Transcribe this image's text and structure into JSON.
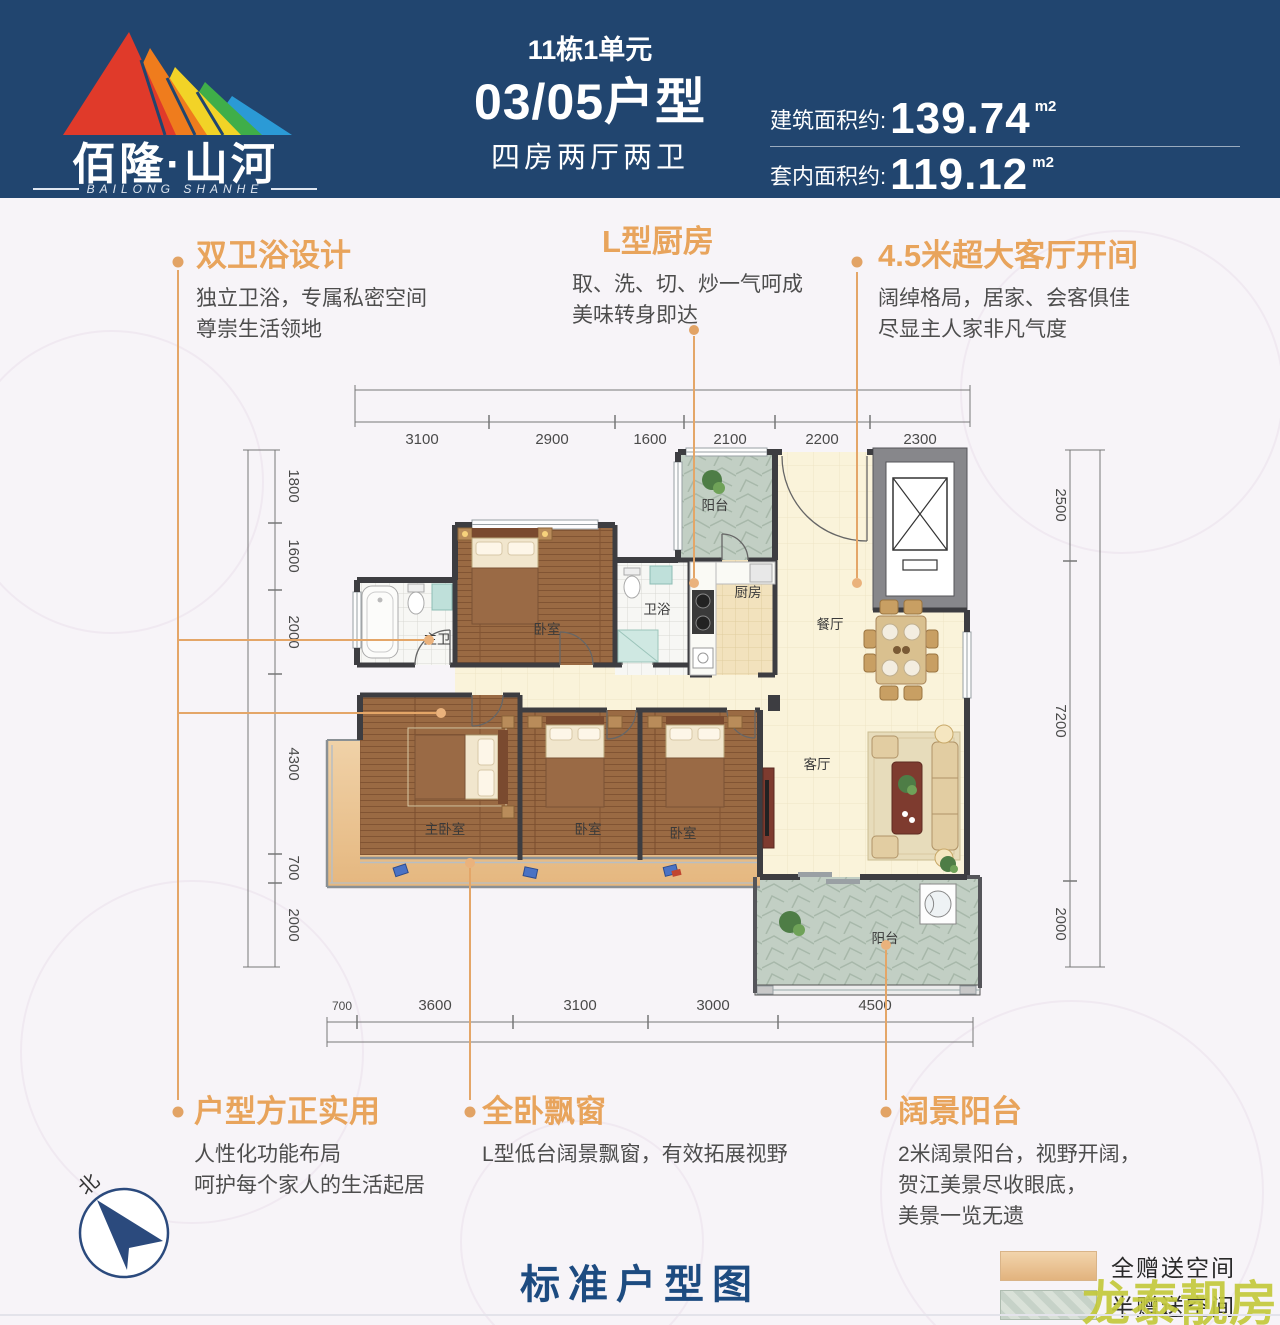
{
  "header": {
    "brand": "佰隆·山河",
    "brand_sub": "BAILONG SHANHE",
    "unit": "11栋1单元",
    "type": "03/05户型",
    "rooms": "四房两厅两卫",
    "area_build_label": "建筑面积约:",
    "area_build": "139.74",
    "area_build_unit": "m2",
    "area_inner_label": "套内面积约:",
    "area_inner": "119.12",
    "area_inner_unit": "m2"
  },
  "callouts": {
    "dual_bath": {
      "title": "双卫浴设计",
      "line1": "独立卫浴，专属私密空间",
      "line2": "尊崇生活领地"
    },
    "kitchen": {
      "title": "L型厨房",
      "line1": "取、洗、切、炒一气呵成",
      "line2": "美味转身即达"
    },
    "living": {
      "title": "4.5米超大客厅开间",
      "line1": "阔绰格局，居家、会客俱佳",
      "line2": "尽显主人家非凡气度"
    },
    "square": {
      "title": "户型方正实用",
      "line1": "人性化功能布局",
      "line2": "呵护每个家人的生活起居"
    },
    "baywindow": {
      "title": "全卧飘窗",
      "line1": "L型低台阔景飘窗，有效拓展视野"
    },
    "balcony": {
      "title": "阔景阳台",
      "line1": "2米阔景阳台，视野开阔，",
      "line2": "贺江美景尽收眼底，",
      "line3": "美景一览无遗"
    }
  },
  "plan": {
    "rooms": {
      "balcony_top": "阳台",
      "kitchen": "厨房",
      "bath": "卫浴",
      "bedroom_top": "卧室",
      "master_bath": "主卫",
      "dining": "餐厅",
      "living": "客厅",
      "master_bedroom": "主卧室",
      "bedroom2": "卧室",
      "bedroom3": "卧室",
      "balcony_bottom": "阳台"
    },
    "dims": {
      "top": [
        "3100",
        "2900",
        "1600",
        "2100",
        "2200",
        "2300"
      ],
      "left": [
        "1800",
        "1600",
        "2000",
        "4300",
        "700",
        "2000"
      ],
      "right": [
        "2500",
        "7200",
        "2000"
      ],
      "bottom": [
        "700",
        "3600",
        "3100",
        "3000",
        "4500"
      ]
    }
  },
  "footer": {
    "title": "标准户型图",
    "legend_full": "全赠送空间",
    "legend_half": "半赠送空间",
    "compass": "北",
    "watermark": "龙泰靓房"
  }
}
